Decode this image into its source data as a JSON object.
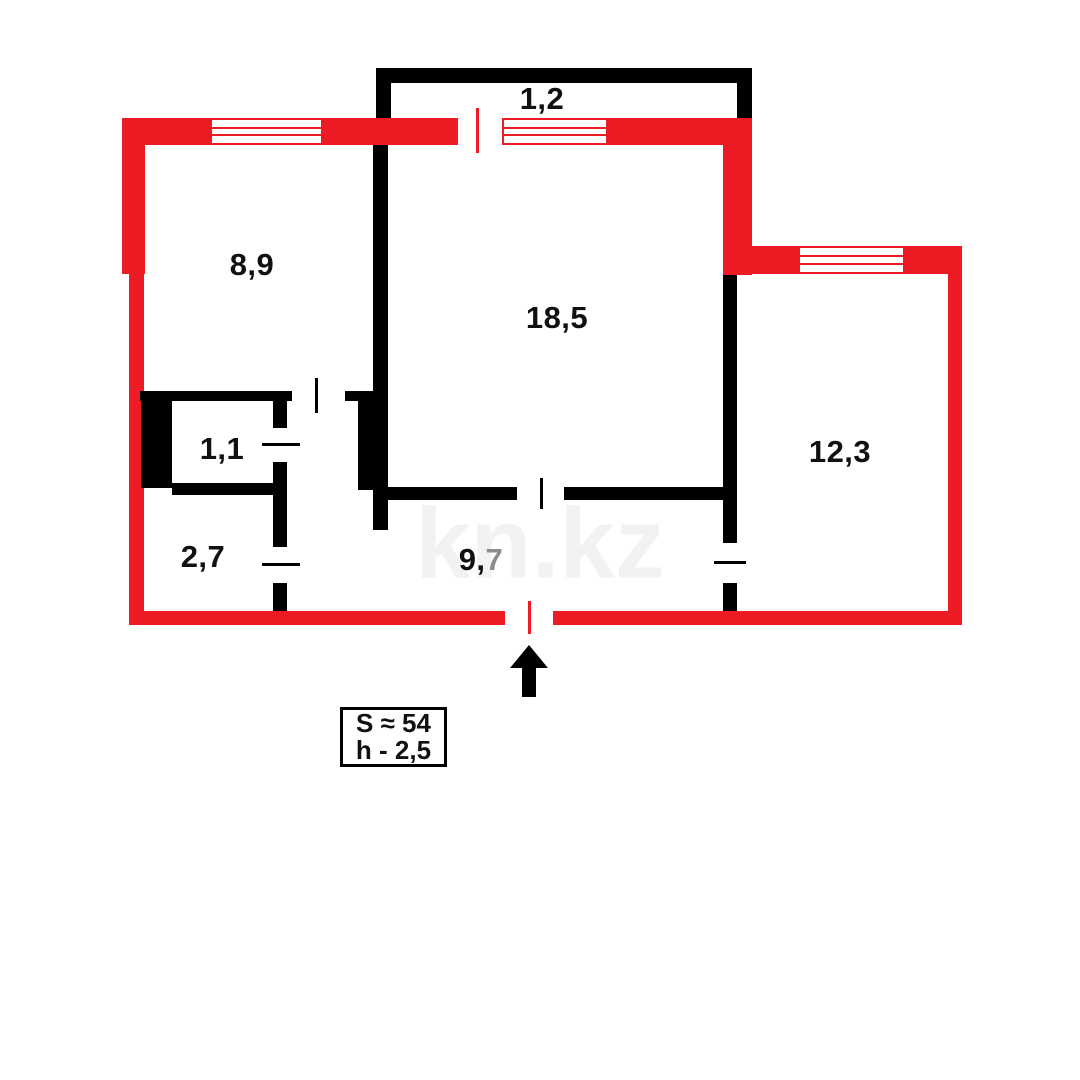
{
  "plan": {
    "type": "apartment-floor-plan",
    "areas": {
      "balcony": "1,2",
      "room_top_left": "8,9",
      "room_center": "18,5",
      "room_right": "12,3",
      "wc": "1,1",
      "bathroom": "2,7",
      "hall_prefix": "9,",
      "hall_suffix": "7"
    },
    "info_box": {
      "total_area": "S ≈ 54",
      "ceiling_height": "h - 2,5"
    }
  },
  "watermark": {
    "text": "kn.kz"
  },
  "colors": {
    "outer_wall": "#ED1C24",
    "inner_wall": "#000000",
    "label_text": "#111111",
    "muted_digit": "#8c8c8c",
    "watermark": "#f2f2f2"
  }
}
